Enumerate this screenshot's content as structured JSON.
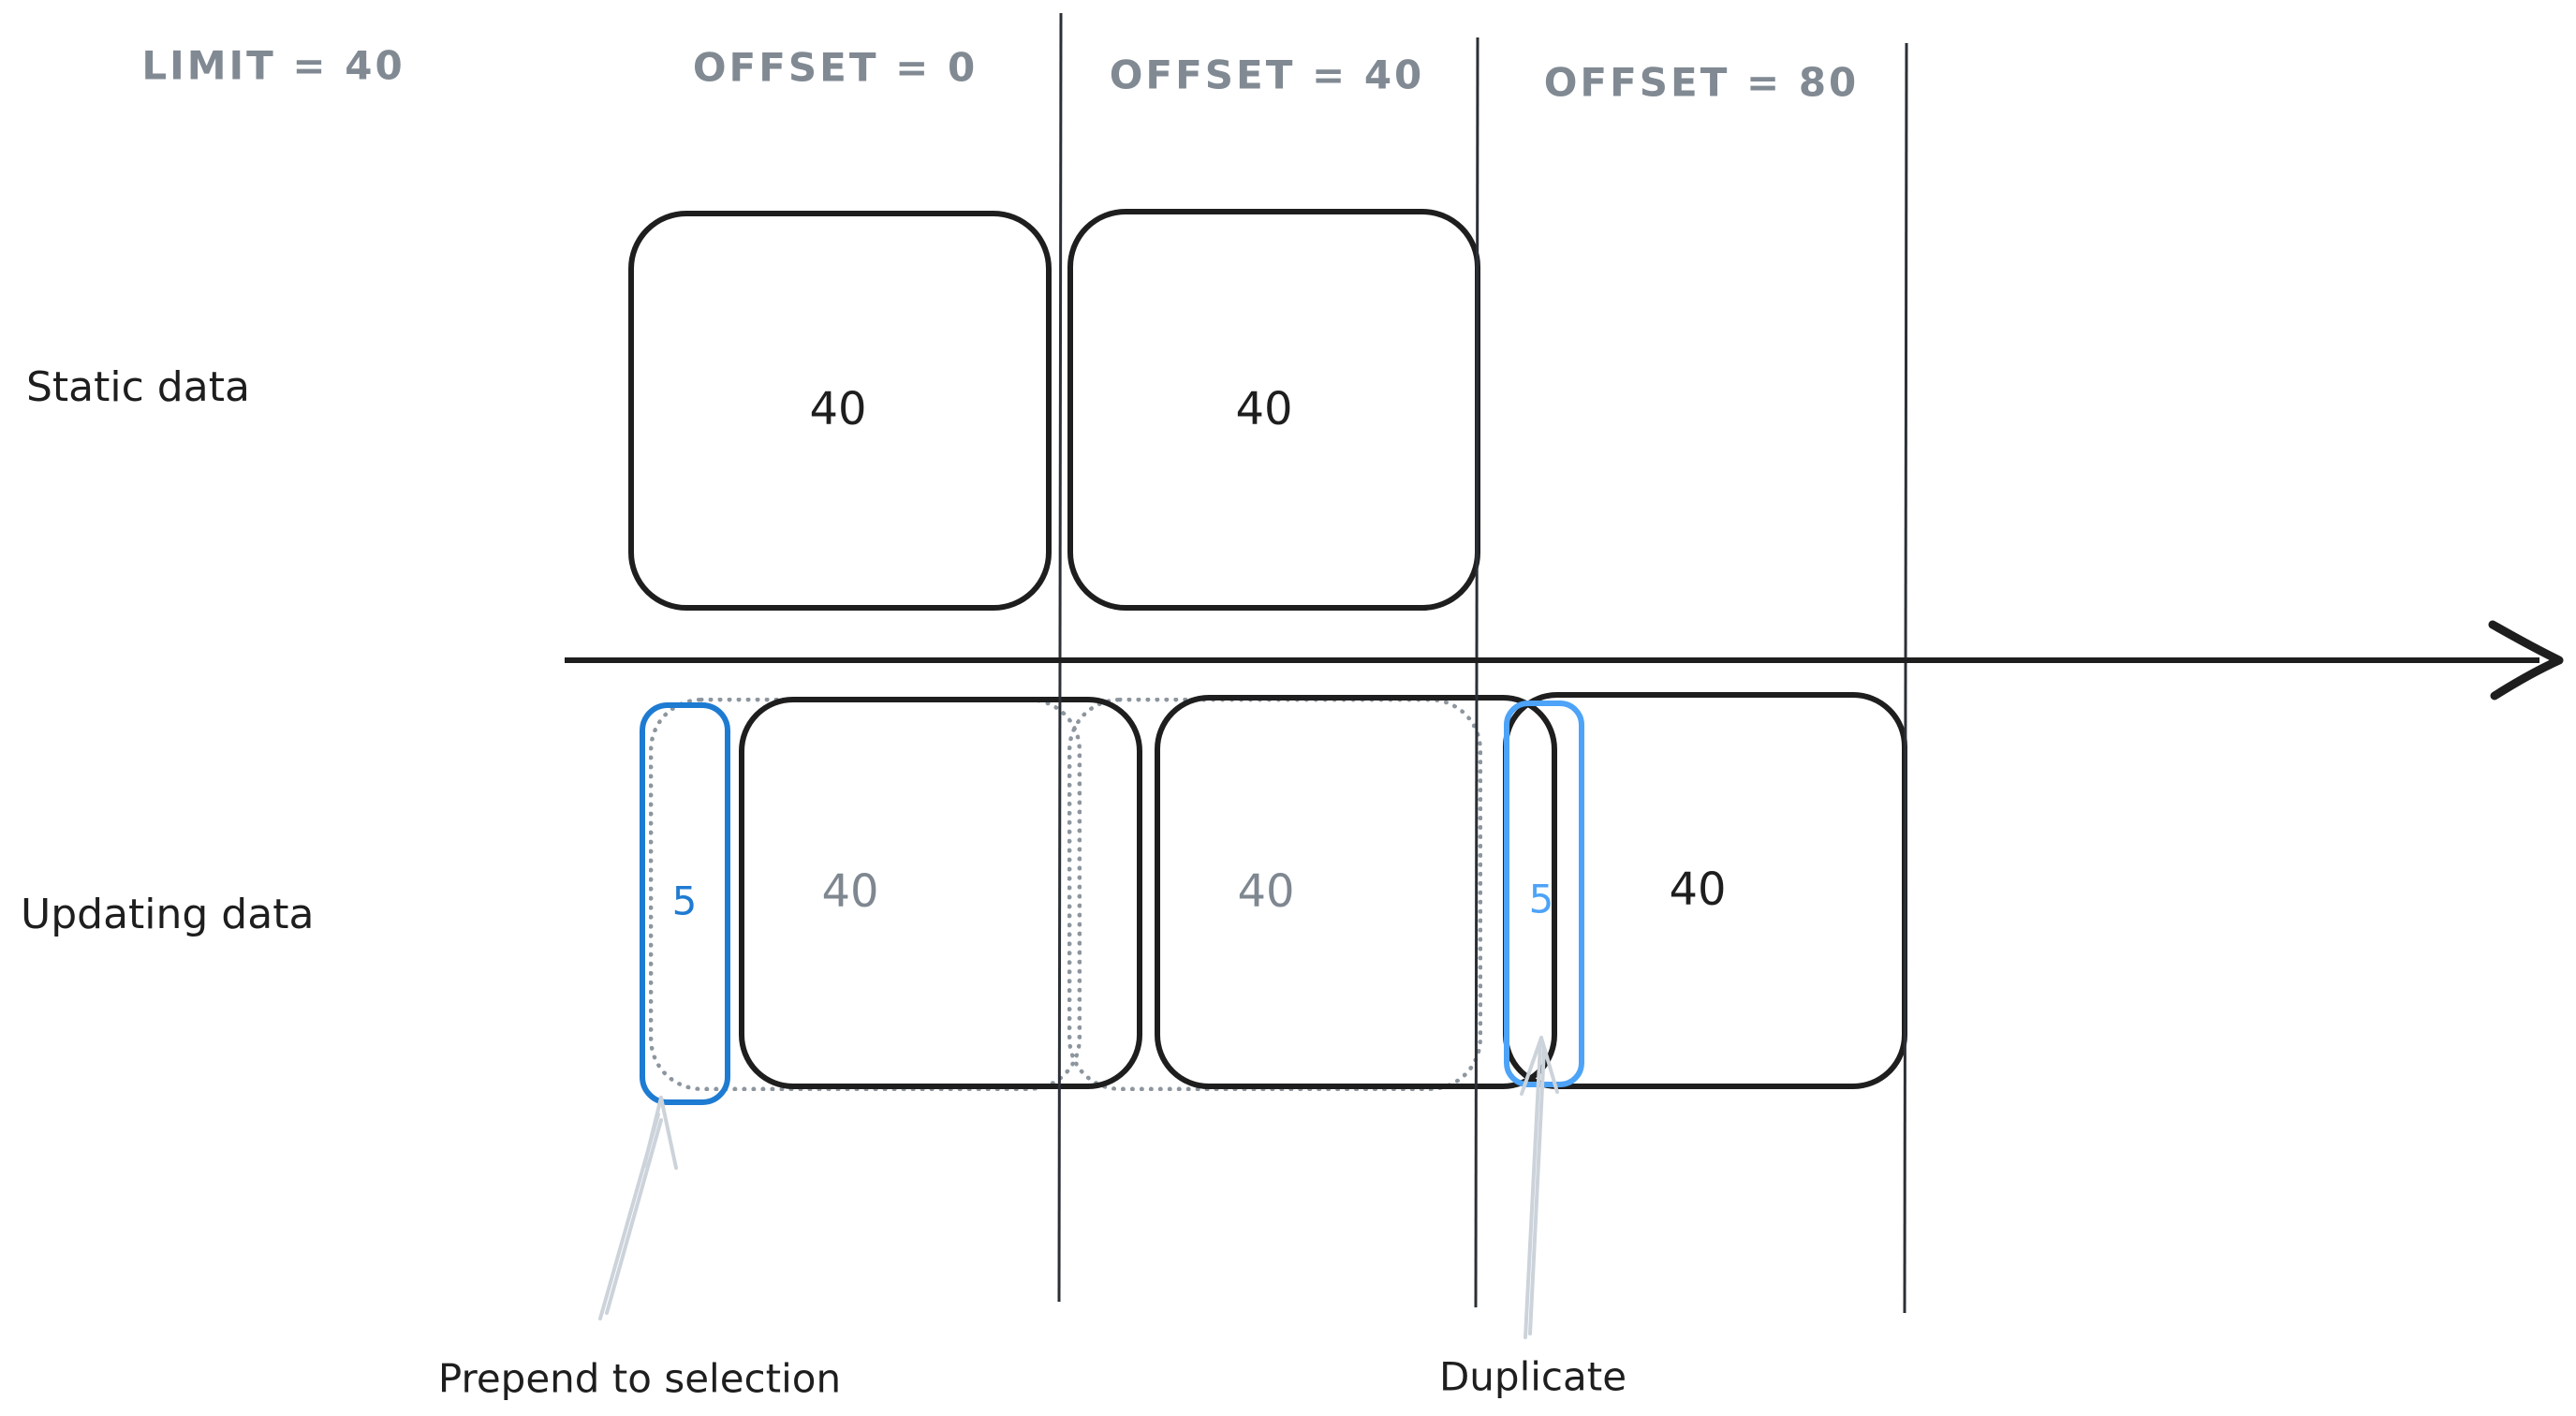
{
  "diagram": {
    "title_row": {
      "limit_label": "LIMIT = 40",
      "offset0_label": "OFFSET = 0",
      "offset40_label": "OFFSET = 40",
      "offset80_label": "OFFSET = 80"
    },
    "rows": {
      "static_label": "Static data",
      "updating_label": "Updating data"
    },
    "static_row": {
      "box1_count": "40",
      "box2_count": "40"
    },
    "updating_row": {
      "prepended_count": "5",
      "box1_count": "40",
      "box2_count": "40",
      "duplicate_count": "5",
      "box3_count": "40"
    },
    "annotations": {
      "prepend_label": "Prepend to selection",
      "duplicate_label": "Duplicate"
    },
    "colors": {
      "stroke_black": "#1e1e1e",
      "muted_gray_text": "#7f8790",
      "header_gray_text": "#818a93",
      "ghost_dotted_gray": "#8d969e",
      "accent_blue_dark": "#1e7bd2",
      "accent_blue_light": "#4da3f7",
      "annotation_arrow_gray": "#ccd3da"
    }
  }
}
